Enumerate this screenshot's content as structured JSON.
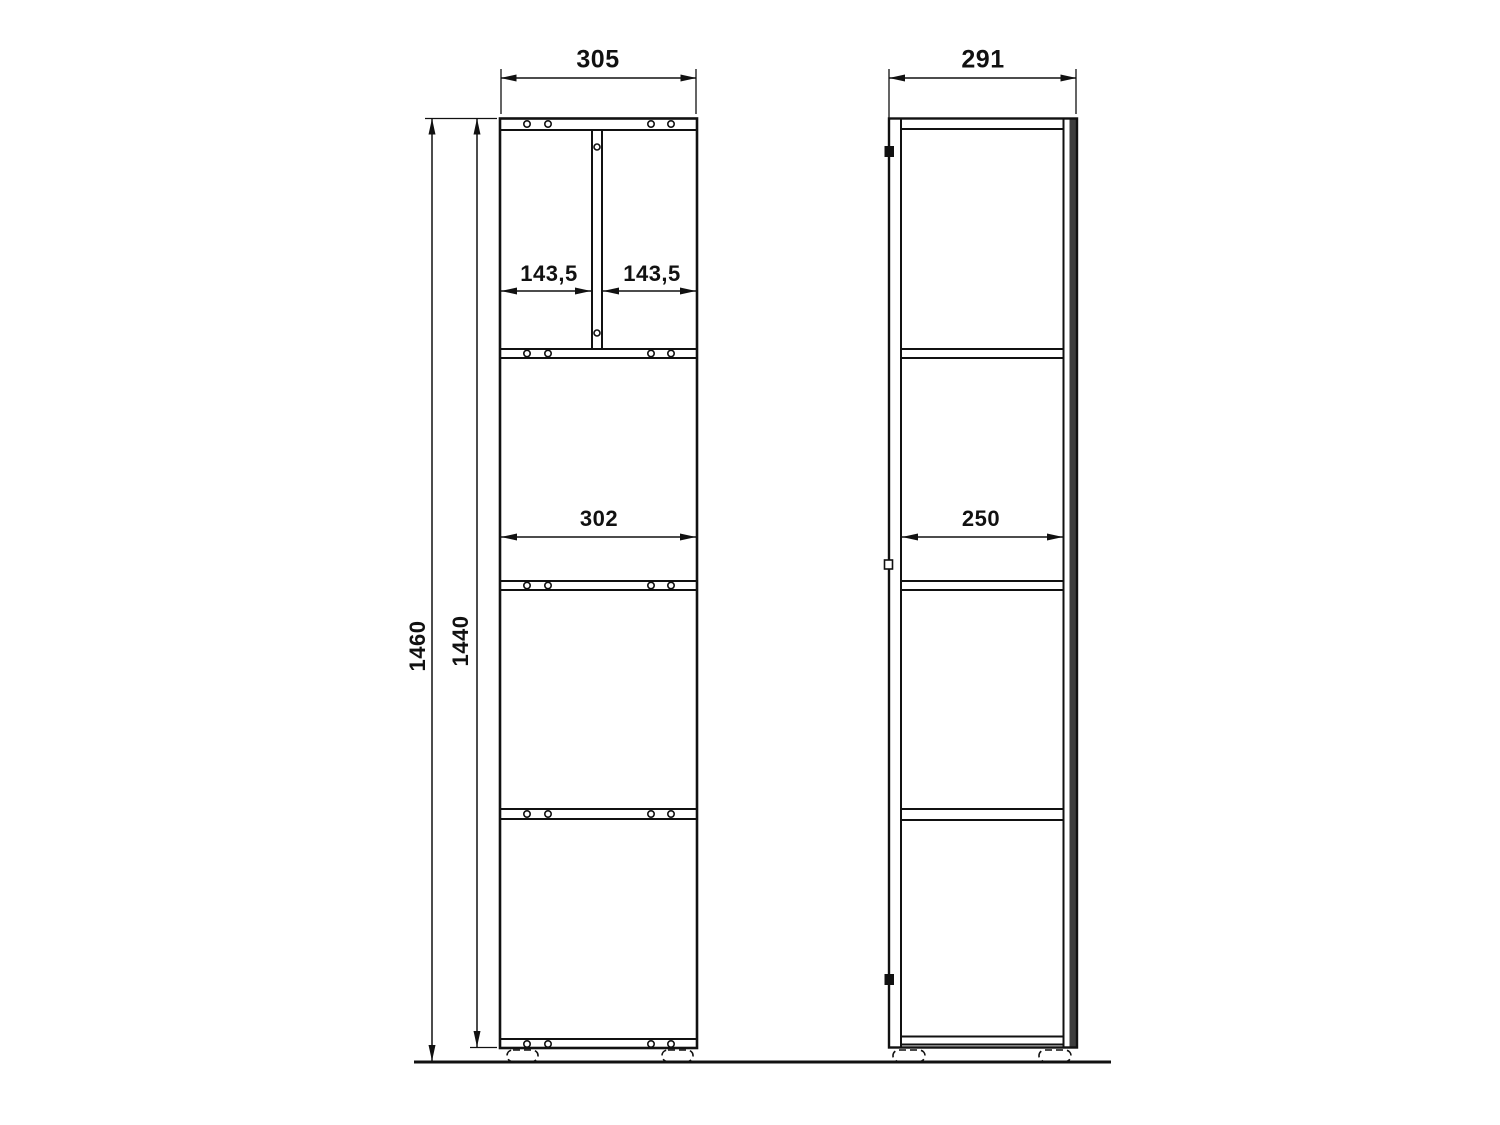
{
  "drawing_type": "furniture dimension drawing",
  "colors": {
    "background": "#ffffff",
    "line": "#111111",
    "back_panel": "#3d3d3d"
  },
  "front_view": {
    "overall_width": "305",
    "overall_height": "1460",
    "body_height": "1440",
    "inner_width": "302",
    "left_compartment_width": "143,5",
    "right_compartment_width": "143,5"
  },
  "side_view": {
    "overall_depth": "291",
    "inner_depth": "250"
  }
}
